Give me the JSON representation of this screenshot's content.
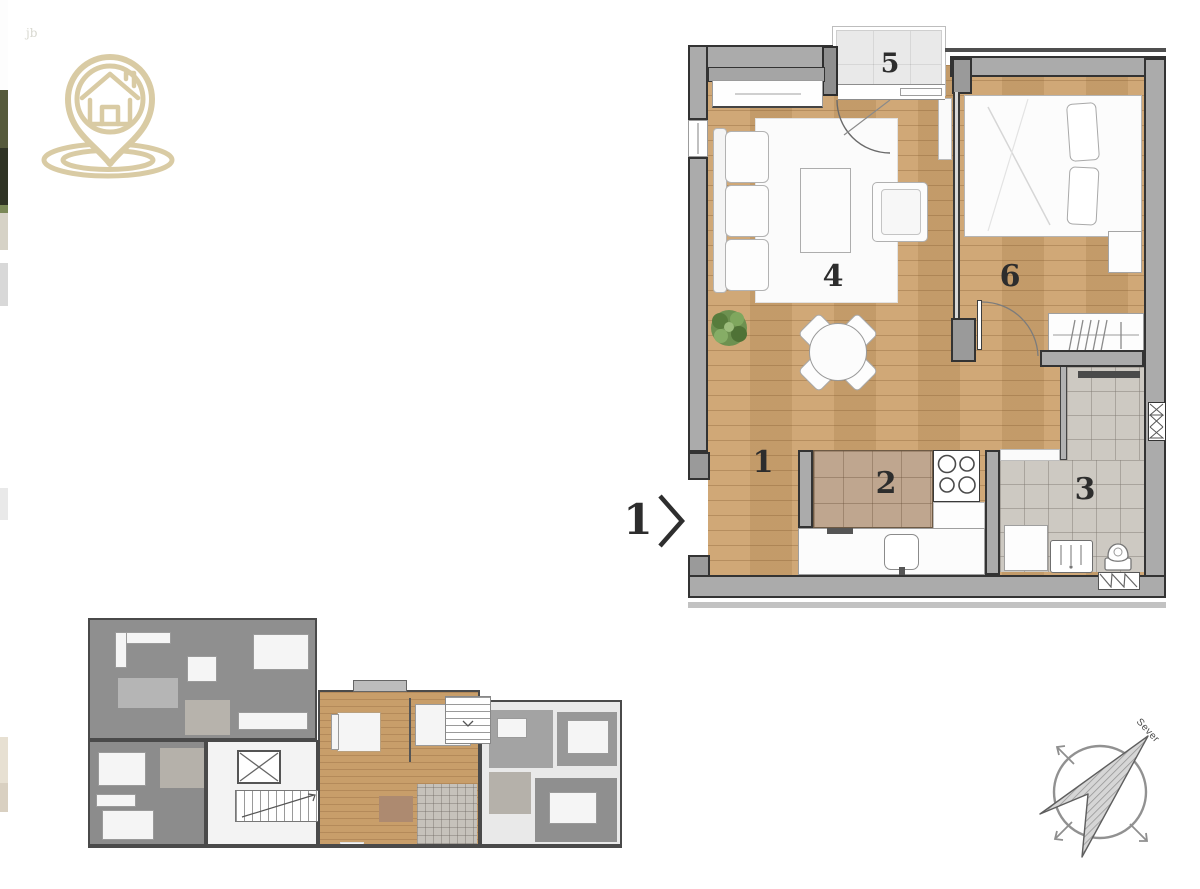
{
  "logo": {
    "icon": "house-location-pin",
    "color": "#d9cba4"
  },
  "corner_mark": "jb",
  "floor_plan": {
    "rooms": [
      {
        "number": "1",
        "type": "hallway"
      },
      {
        "number": "2",
        "type": "kitchen"
      },
      {
        "number": "3",
        "type": "bathroom"
      },
      {
        "number": "4",
        "type": "living-room"
      },
      {
        "number": "5",
        "type": "terrace"
      },
      {
        "number": "6",
        "type": "bedroom"
      }
    ],
    "entry": {
      "label": "1"
    }
  },
  "overview_plan": {
    "highlighted_unit_room_count": 6
  },
  "compass": {
    "label": "Sever"
  },
  "colors": {
    "logo_beige": "#d9cba4",
    "wall_gray": "#ababab",
    "wood_floor": "#cda36f",
    "kitchen_tile": "#bfa68f",
    "bath_tile": "#cdc9c2",
    "terrace_tile": "#e9e9e9",
    "highlight_unit_wood": "#c89e6a"
  }
}
